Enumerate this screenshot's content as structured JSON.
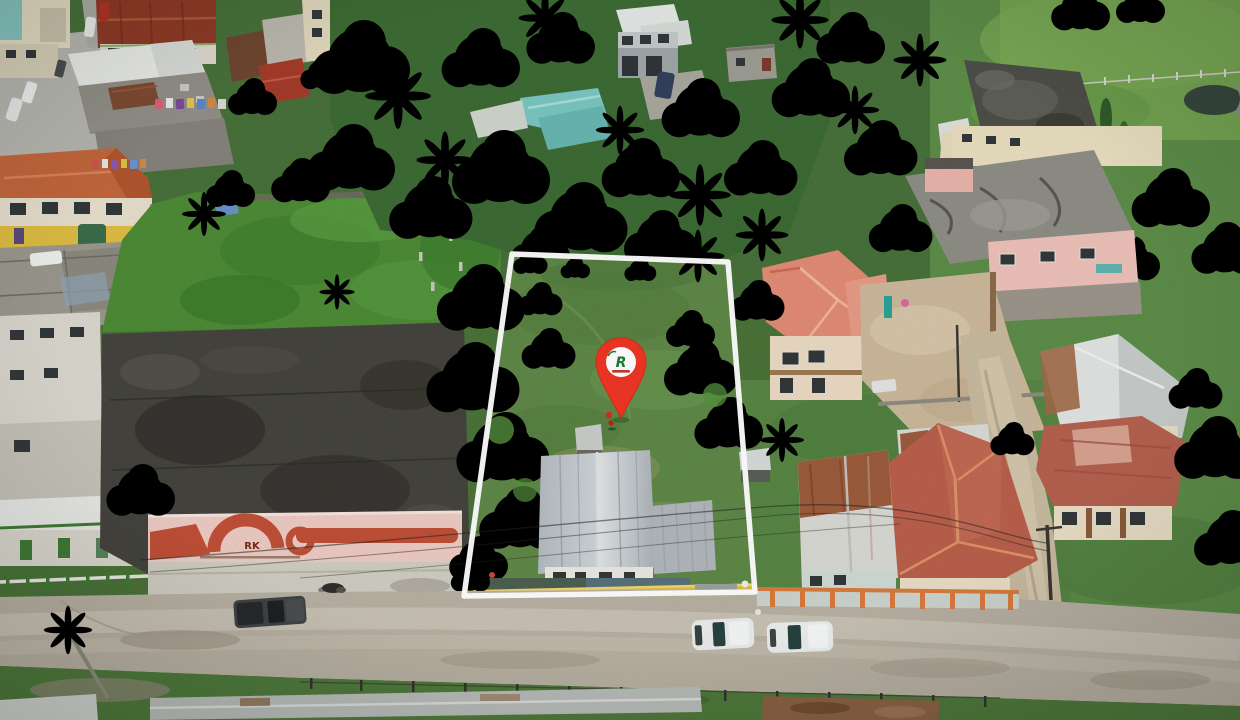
{
  "scene": {
    "type": "aerial-drone-photo",
    "subject": "vacant-residential-lot-with-boundary-overlay"
  },
  "marker": {
    "monogram": "R",
    "pin_color": "#ee3524",
    "pin_edge_color": "#d92a1b",
    "badge_color": "#ffffff",
    "monogram_color": "#1e7a34",
    "subtext_color": "#c0392b"
  },
  "boundary": {
    "color": "#ffffff"
  },
  "buildings": {
    "facade_text": "RK"
  },
  "palette": {
    "lot_grass": "#5e8747",
    "lawn": "#5c8c48",
    "field": "#73a351",
    "overgrown": "#4c8a36",
    "tree_dark": "#2d5527",
    "tree_mid": "#3c6e31",
    "tree_light": "#55913e",
    "palm": "#7fae57",
    "road": "#b7b0a2",
    "tar_roof": "#44433d",
    "silver_roof": "#c2c8cc",
    "white_roof": "#e7e9e6",
    "rust_roof": "#8e3a26",
    "orange_roof": "#c2663c",
    "salmon_roof": "#e18b75",
    "red_hip_roof": "#b85f4b",
    "faded_red_roof": "#b4604e",
    "teal_roof": "#79c5c0",
    "pink_facade": "#eccac2",
    "facade_decor": "#bf4f37",
    "cream_wall": "#e3d9bb",
    "yellow_fence": "#dfbc47",
    "orange_fence": "#d87a3c",
    "pond": "#36463b"
  }
}
